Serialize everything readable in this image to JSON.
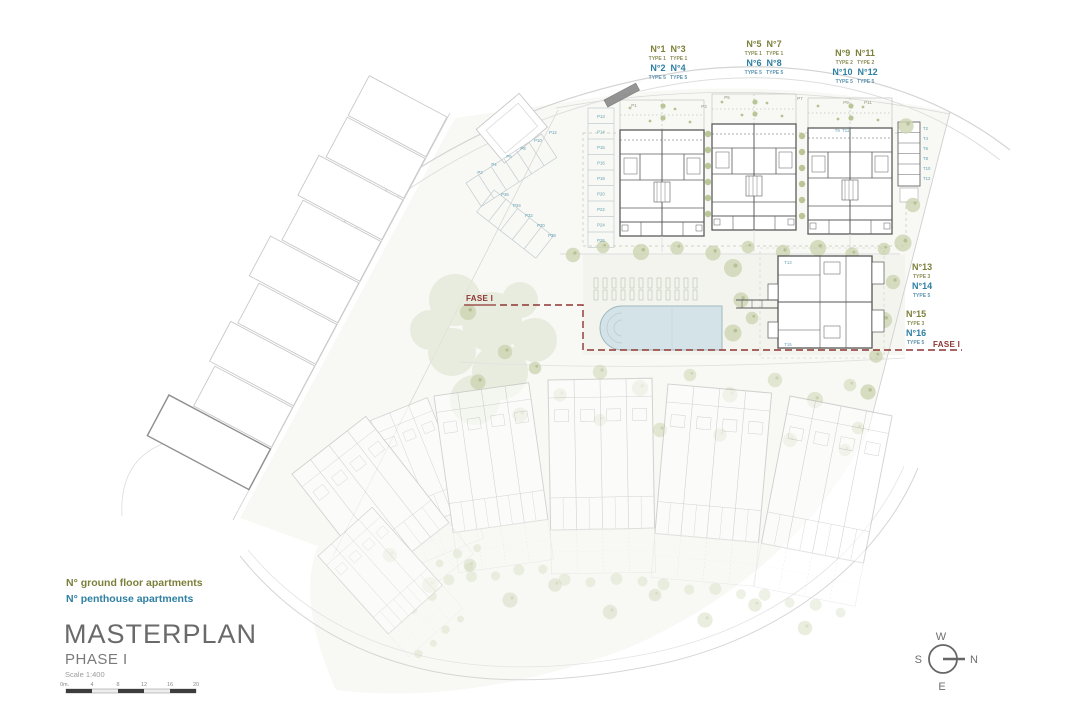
{
  "legend": {
    "ground": "N° ground floor apartments",
    "penthouse": "N° penthouse apartments"
  },
  "title_block": {
    "title": "MASTERPLAN",
    "phase": "PHASE I",
    "scale": "Scale 1:400"
  },
  "scale_bar": {
    "t0": "0m.",
    "t1": "4",
    "t2": "8",
    "t3": "12",
    "t4": "16",
    "t5": "20"
  },
  "compass": {
    "n": "N",
    "w": "W",
    "s": "S",
    "e": "E"
  },
  "fase": {
    "left": "FASE I",
    "right": "FASE I"
  },
  "groups": {
    "g1": {
      "gn": "N°1  N°3",
      "gt": "TYPE 1   TYPE 1",
      "pn": "N°2  N°4",
      "pt": "TYPE 5   TYPE 5"
    },
    "g2": {
      "gn": "N°5  N°7",
      "gt": "TYPE 1   TYPE 1",
      "pn": "N°6  N°8",
      "pt": "TYPE 5   TYPE 5"
    },
    "g3": {
      "gn": "N°9  N°11",
      "gt": "TYPE 2   TYPE 2",
      "pn": "N°10  N°12",
      "pt": "TYPE 5   TYPE 5"
    },
    "g4": {
      "n1": "N°13",
      "t1": "TYPE 3",
      "n2": "N°14",
      "t2": "TYPE 5"
    },
    "g5": {
      "n1": "N°15",
      "t1": "TYPE 3",
      "n2": "N°16",
      "t2": "TYPE 5"
    }
  },
  "parking": {
    "column": [
      "P13",
      "P14",
      "P15",
      "P16",
      "P18",
      "P20",
      "P22",
      "P24",
      "P26"
    ],
    "upper": [
      "P2",
      "P4",
      "P6",
      "P8",
      "P10",
      "P12"
    ],
    "lower": [
      "P36",
      "P34",
      "P32",
      "P30",
      "P28"
    ],
    "gardens": [
      "P1",
      "P3",
      "P5",
      "P7",
      "P9",
      "P11"
    ],
    "storage": [
      "T2",
      "T4",
      "T6",
      "T8",
      "T10",
      "T12"
    ],
    "tpair": "T9  T11",
    "t13": "T13",
    "t15": "T15"
  },
  "colors": {
    "ground_floor_label": "#7c7f3a",
    "penthouse_label": "#2e7fa3",
    "phase_boundary": "#8e3432",
    "pool": "#d4e3e8",
    "tree": "#ccd5b2"
  }
}
